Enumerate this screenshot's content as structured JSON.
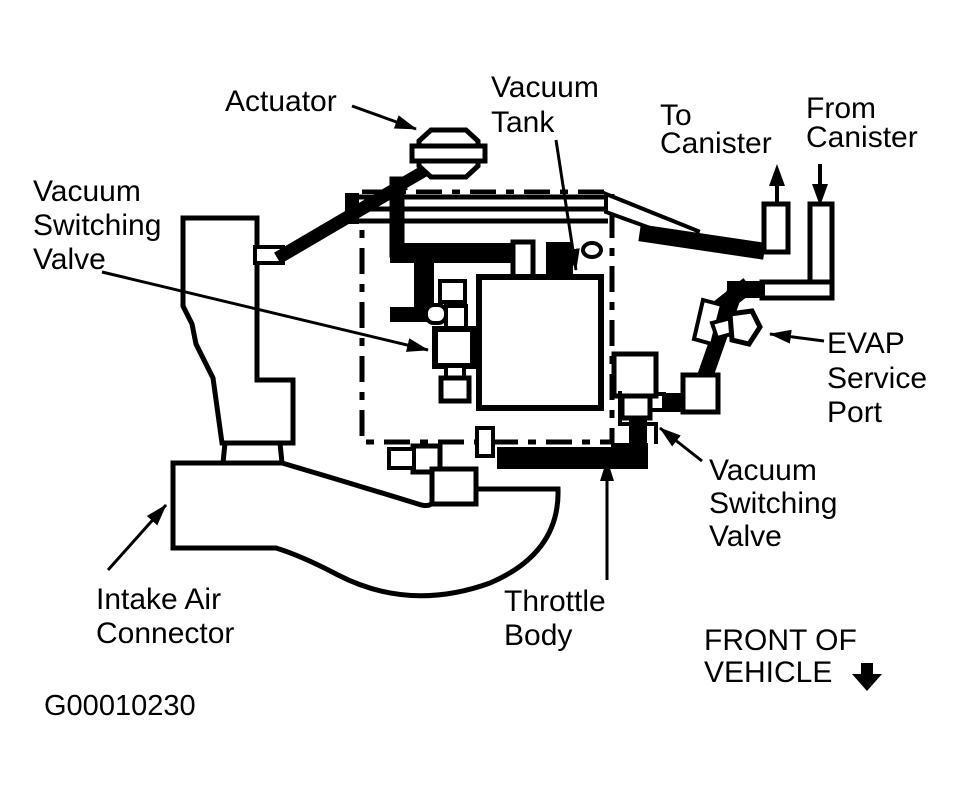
{
  "figure_code": "G00010230",
  "colors": {
    "ink": "#000000",
    "paper": "#ffffff"
  },
  "icons": {
    "to_canister_arrow": "up-arrow",
    "from_canister_arrow": "down-arrow",
    "front_of_vehicle_arrow": "down-arrow"
  },
  "labels": {
    "actuator": {
      "lines": [
        "Actuator"
      ]
    },
    "vacuum_tank": {
      "lines": [
        "Vacuum",
        "Tank"
      ]
    },
    "to_canister": {
      "lines": [
        "To",
        "Canister"
      ]
    },
    "from_canister": {
      "lines": [
        "From",
        "Canister"
      ]
    },
    "vacuum_switching_valve_left": {
      "lines": [
        "Vacuum",
        "Switching",
        "Valve"
      ]
    },
    "evap_service_port": {
      "lines": [
        "EVAP",
        "Service",
        "Port"
      ]
    },
    "vacuum_switching_valve_right": {
      "lines": [
        "Vacuum",
        "Switching",
        "Valve"
      ]
    },
    "intake_air_connector": {
      "lines": [
        "Intake Air",
        "Connector"
      ]
    },
    "throttle_body": {
      "lines": [
        "Throttle",
        "Body"
      ]
    },
    "front_of_vehicle": {
      "lines": [
        "FRONT OF",
        "VEHICLE"
      ]
    }
  }
}
